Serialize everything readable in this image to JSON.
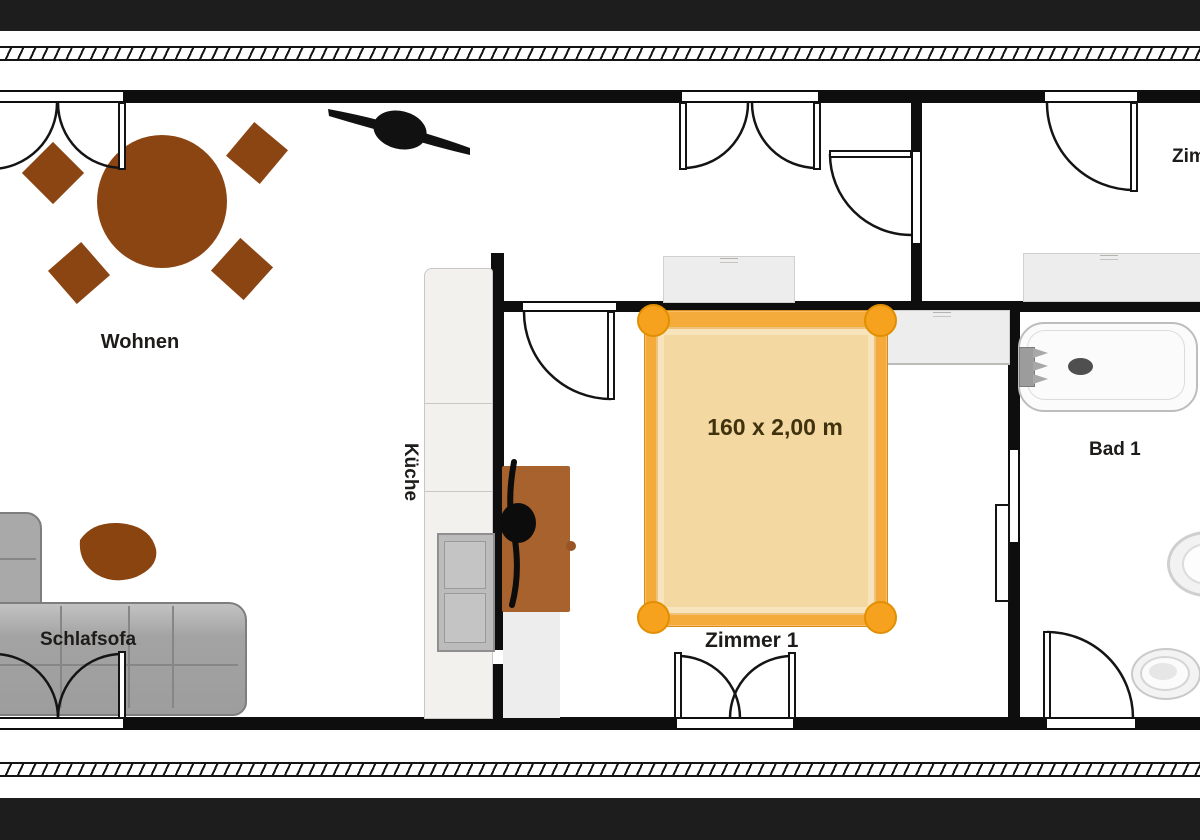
{
  "title": "Apartment floor plan",
  "rooms": {
    "wohnen": {
      "label": "Wohnen"
    },
    "kueche": {
      "label": "Küche"
    },
    "zimmer1": {
      "label": "Zimmer 1"
    },
    "bad1": {
      "label": "Bad 1"
    },
    "zimmer2": {
      "label": "Zimmer 2"
    }
  },
  "furniture": {
    "sofa_label": "Schlafsofa",
    "bed_size_label": "160 x 2,00 m"
  },
  "colors": {
    "wall": "#0e0e0e",
    "frame_bar": "#1d1d1d",
    "furniture_brown": "#8B4513",
    "kitchen_table_brown": "#a8622d",
    "bed_frame_orange": "#f5aa3c",
    "bed_knob_orange": "#f6a21e",
    "bed_mattress": "#f3d8a1",
    "sofa_gray": "#ababab",
    "cabinet_gray": "#ededed",
    "appliance_gray": "#bcbcbc"
  }
}
